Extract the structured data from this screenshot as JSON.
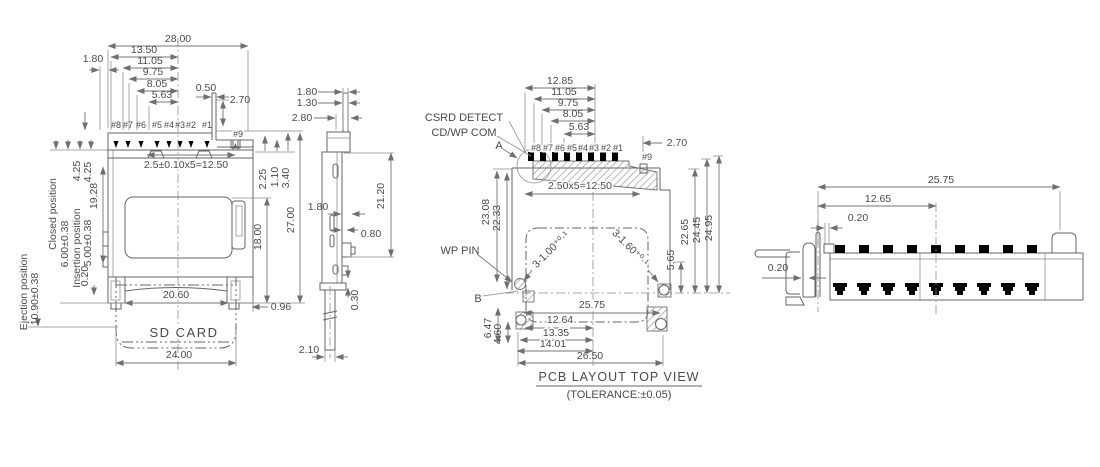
{
  "front": {
    "dim_28_00": "28.00",
    "dim_13_50": "13.50",
    "dim_11_05": "11.05",
    "dim_9_75": "9.75",
    "dim_8_05": "8.05",
    "dim_5_63": "5.63",
    "dim_0_50": "0.50",
    "dim_2_70": "2.70",
    "dim_1_80": "1.80",
    "pins": [
      "#8",
      "#7",
      "#6",
      "#5",
      "#4",
      "#3",
      "#2",
      "#1"
    ],
    "pin9": "#9",
    "pitch_note": "2.5±0.10x5=12.50",
    "dim_2_25": "2.25",
    "dim_1_10": "1.10",
    "dim_3_40": "3.40",
    "dim_27_00": "27.00",
    "dim_18_00": "18.00",
    "dim_0_96": "0.96",
    "dim_20_60": "20.60",
    "dim_24_00": "24.00",
    "card_label": "SD CARD",
    "ejection_label": "Ejection position",
    "ejection_value": "10.90±0.38",
    "closed_label": "Closed position",
    "closed_value": "6.00±0.38",
    "insertion_label": "Insertion position",
    "insertion_value": "5.00±0.38",
    "dim_4_25_a": "4.25",
    "dim_4_25_b": "4.25",
    "dim_19_28": "19.28",
    "dim_0_20": "0.20"
  },
  "side": {
    "dim_1_80_top": "1.80",
    "dim_1_30": "1.30",
    "dim_2_80": "2.80",
    "dim_21_20": "21.20",
    "dim_1_80_mid": "1.80",
    "dim_0_80": "0.80",
    "dim_0_30": "0.30",
    "dim_2_10": "2.10"
  },
  "pcb": {
    "label_csrd_detect": "CSRD DETECT",
    "label_cd_wp_com": "CD/WP COM",
    "label_a": "A",
    "label_b": "B",
    "label_wp_pin": "WP PIN",
    "dim_12_85": "12.85",
    "dim_11_05": "11.05",
    "dim_9_75": "9.75",
    "dim_8_05": "8.05",
    "dim_5_63": "5.63",
    "dim_2_70": "2.70",
    "pins": [
      "#8",
      "#7",
      "#6",
      "#5",
      "#4",
      "#3",
      "#2",
      "#1"
    ],
    "pin9": "#9",
    "pitch_note": "2.50x5=12.50",
    "dim_23_08": "23.08",
    "dim_22_33": "22.33",
    "hole_note_left": "3-1.00⁺⁰·¹",
    "hole_note_right": "3-1.60⁺⁰·¹",
    "dim_25_75": "25.75",
    "dim_12_64": "12.64",
    "dim_13_35": "13.35",
    "dim_14_01": "14.01",
    "dim_26_50": "26.50",
    "dim_6_47": "6.47",
    "dim_4_60": "4.60",
    "dim_5_65": "5.65",
    "dim_22_65": "22.65",
    "dim_24_45": "24.45",
    "dim_24_95": "24.95",
    "caption_title": "PCB LAYOUT TOP VIEW",
    "caption_tolerance": "(TOLERANCE:±0.05)"
  },
  "right": {
    "dim_25_75": "25.75",
    "dim_12_65": "12.65",
    "dim_0_20_top": "0.20",
    "dim_0_20_left": "0.20"
  }
}
